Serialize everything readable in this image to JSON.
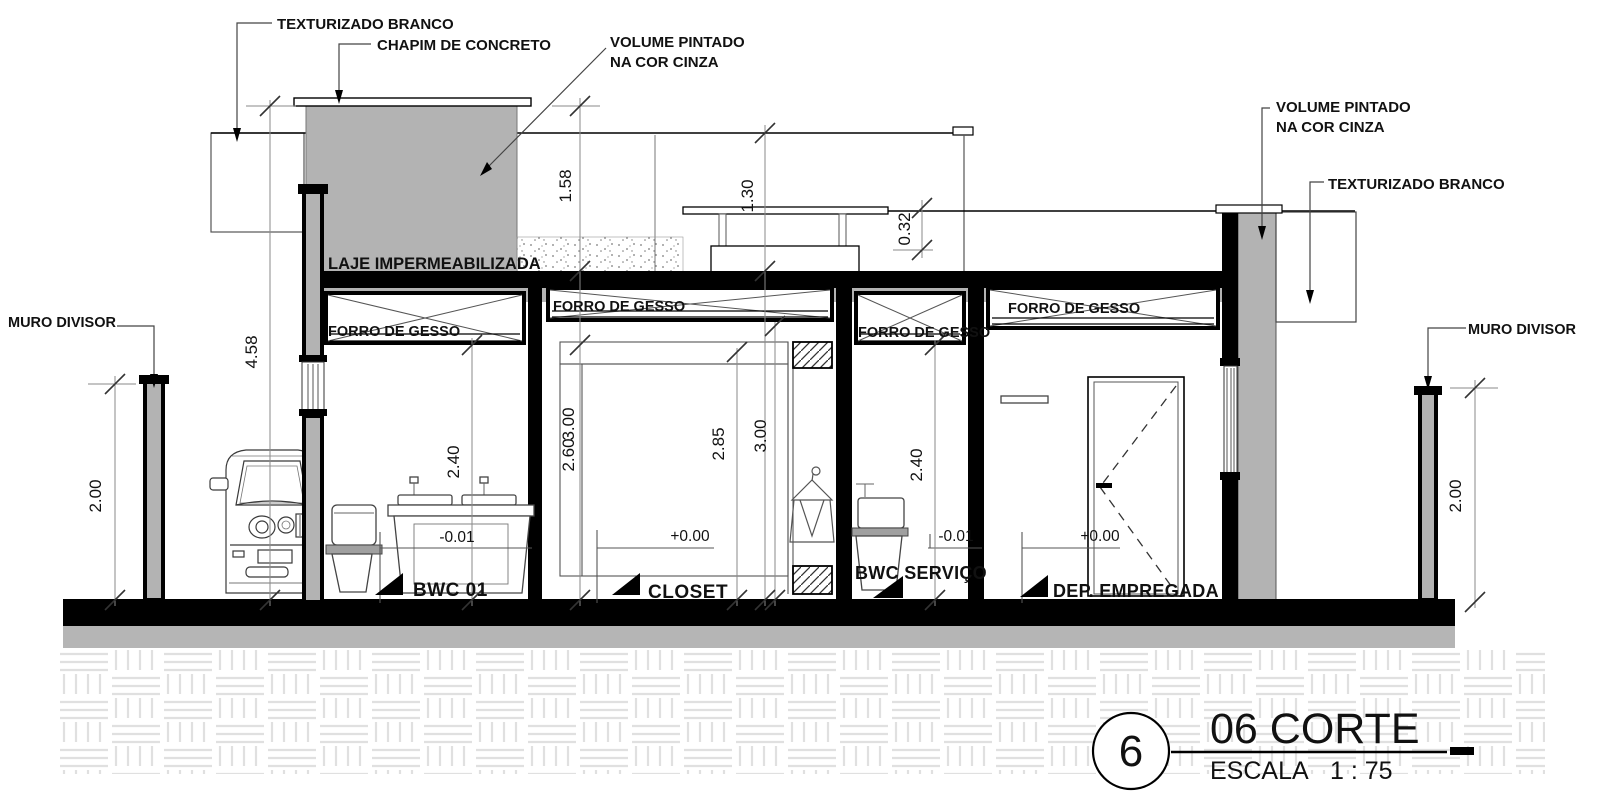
{
  "title_block": {
    "detail_number": "6",
    "title": "06 CORTE",
    "scale_label": "ESCALA",
    "scale_value": "1 : 75"
  },
  "annotations": {
    "texturizado_branco_left": "TEXTURIZADO BRANCO",
    "chapim_de_concreto": "CHAPIM DE CONCRETO",
    "volume_pintado_left_line1": "VOLUME PINTADO",
    "volume_pintado_left_line2": "NA COR CINZA",
    "volume_pintado_right_line1": "VOLUME PINTADO",
    "volume_pintado_right_line2": "NA COR CINZA",
    "texturizado_branco_right": "TEXTURIZADO BRANCO",
    "muro_divisor_left": "MURO DIVISOR",
    "muro_divisor_right": "MURO DIVISOR",
    "laje_impermeabilizada": "LAJE IMPERMEABILIZADA"
  },
  "ceilings": {
    "forro_bwc01": "FORRO DE GESSO",
    "forro_closet": "FORRO DE GESSO",
    "forro_bwc_servico": "FORRO DE GESSO",
    "forro_dep_empregada": "FORRO DE GESSO"
  },
  "rooms": {
    "bwc01": {
      "name": "BWC 01",
      "level": "-0.01"
    },
    "closet": {
      "name": "CLOSET",
      "level": "+0.00"
    },
    "bwc_servico": {
      "name": "BWC SERVIÇO",
      "level": "-0.01"
    },
    "dep_empregada": {
      "name": "DEP. EMPREGADA",
      "level": "+0.00"
    }
  },
  "dimensions": {
    "total_height": "4.58",
    "parapet_left": "1.58",
    "parapet_center": "1.30",
    "parapet_right": "0.32",
    "muro_left": "2.00",
    "muro_right": "2.00",
    "bwc01_height": "2.40",
    "bwc_servico_height": "2.40",
    "closet_height_a": "2.60",
    "closet_height_b": "3.00",
    "closet_wardrobe": "2.85",
    "closet_ceiling": "3.00"
  },
  "colors": {
    "paint_gray": "#b3b3b3",
    "line_black": "#000000",
    "dim_gray": "#8a8a8a",
    "hatch_light": "#e0e0e0"
  }
}
